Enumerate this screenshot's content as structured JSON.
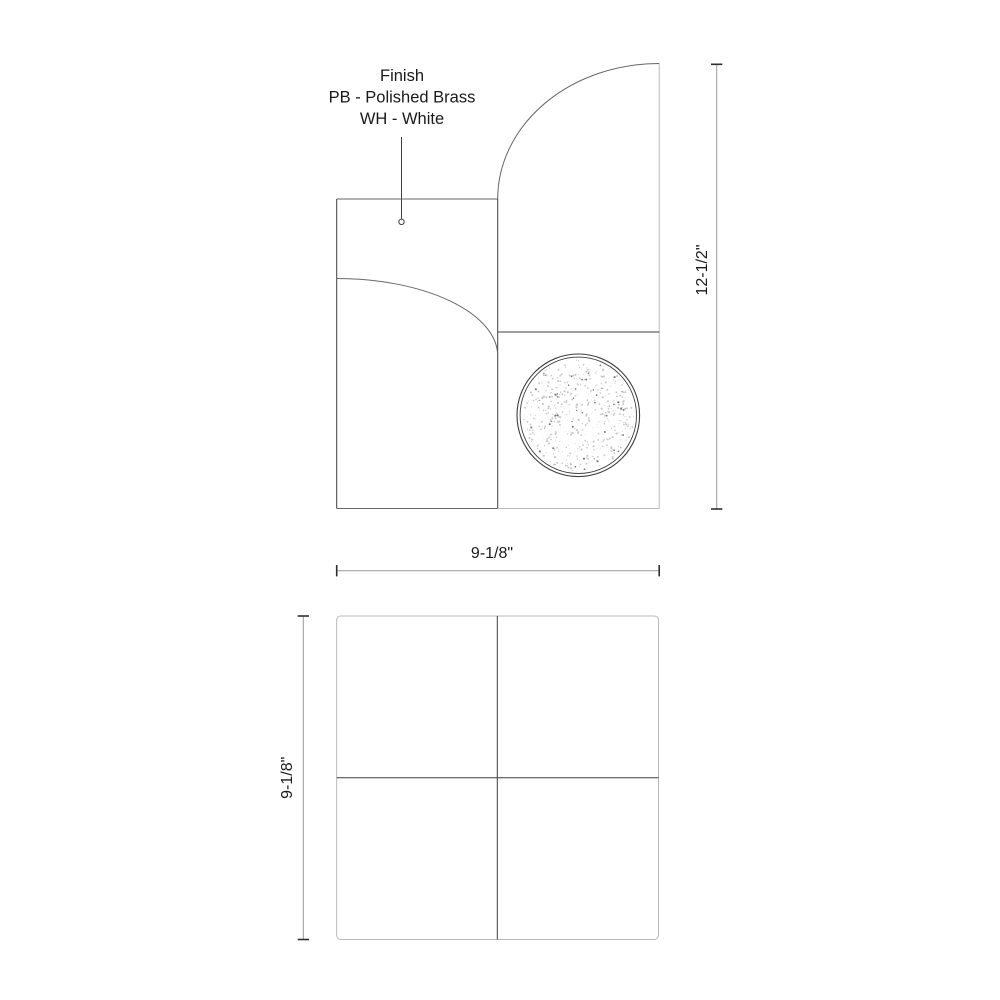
{
  "annotation": {
    "lines": [
      "Finish",
      "PB - Polished Brass",
      "WH - White"
    ]
  },
  "dimensions": {
    "height_label": "12-1/2\"",
    "width_label": "9-1/8\"",
    "depth_label": "9-1/8\""
  },
  "colors": {
    "background": "#ffffff",
    "line_dark": "#3f3f3f",
    "line_medium": "#666666",
    "line_light": "#b8b8b8",
    "dimension_line": "#9a9a9a",
    "tick": "#2e2e2e",
    "text": "#1a1a1a",
    "stipple_light": "#c8c8c8",
    "stipple_dark": "#777777"
  }
}
